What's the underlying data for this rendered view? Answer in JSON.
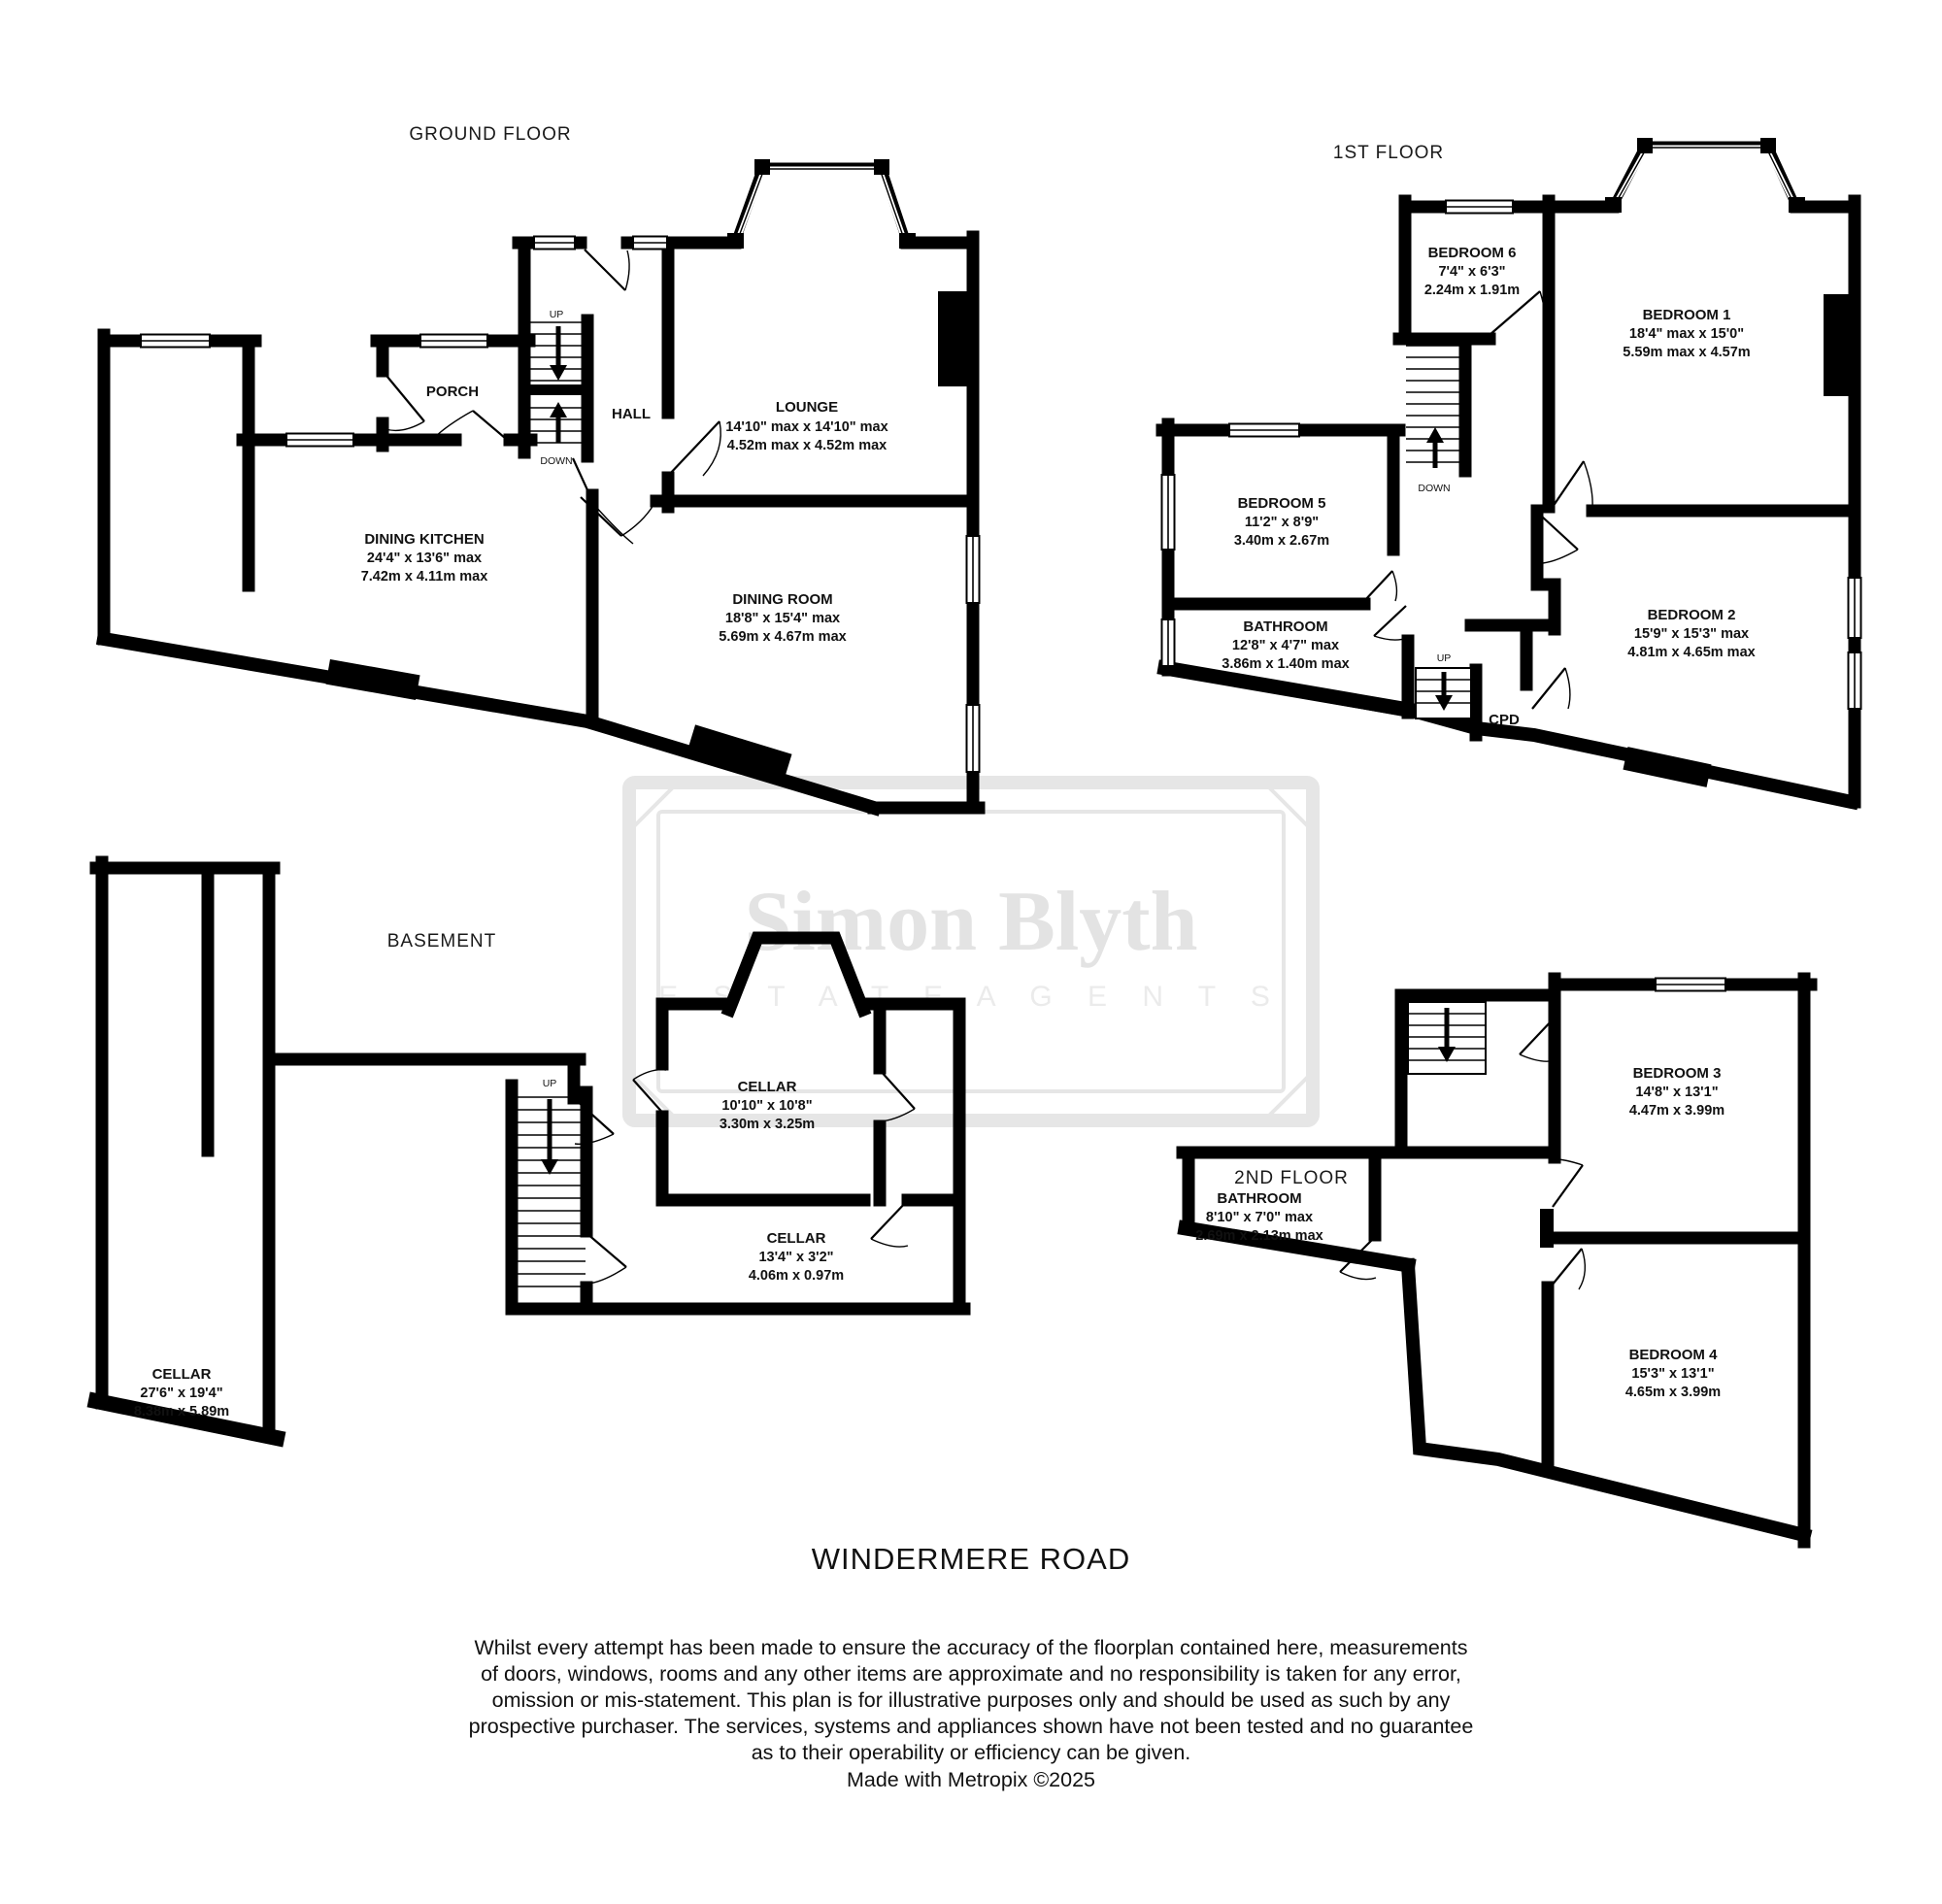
{
  "colors": {
    "wall": "#000000",
    "background": "#ffffff",
    "watermark": "#e3e3e3"
  },
  "labels": {
    "up": "UP",
    "down": "DOWN"
  },
  "watermark": {
    "line1": "Simon Blyth",
    "line2": "E S T A T E   A G E N T S"
  },
  "title": "WINDERMERE ROAD",
  "credit": "Made with Metropix ©2025",
  "disclaimer": [
    "Whilst every attempt has been made to ensure the accuracy of the floorplan contained here, measurements",
    "of doors, windows, rooms and any other items are approximate and no responsibility is taken for any error,",
    "omission or mis-statement. This plan is for illustrative purposes only and should be used as such by any",
    "prospective purchaser. The services, systems and appliances shown have not been tested and no guarantee",
    "as to their operability or efficiency can be given."
  ],
  "floors": [
    {
      "title": "GROUND FLOOR",
      "rooms": [
        {
          "name": "LOUNGE",
          "dims1": "14'10\" max x 14'10\" max",
          "dims2": "4.52m max x 4.52m max"
        },
        {
          "name": "DINING ROOM",
          "dims1": "18'8\"  x 15'4\" max",
          "dims2": "5.69m  x 4.67m max"
        },
        {
          "name": "DINING KITCHEN",
          "dims1": "24'4\"  x 13'6\" max",
          "dims2": "7.42m  x 4.11m max"
        },
        {
          "name": "HALL"
        },
        {
          "name": "PORCH"
        }
      ]
    },
    {
      "title": "1ST FLOOR",
      "rooms": [
        {
          "name": "BEDROOM 6",
          "dims1": "7'4\"  x 6'3\"",
          "dims2": "2.24m  x 1.91m"
        },
        {
          "name": "BEDROOM 1",
          "dims1": "18'4\" max x 15'0\"",
          "dims2": "5.59m max x 4.57m"
        },
        {
          "name": "BEDROOM 5",
          "dims1": "11'2\"  x 8'9\"",
          "dims2": "3.40m  x 2.67m"
        },
        {
          "name": "BATHROOM",
          "dims1": "12'8\"  x 4'7\" max",
          "dims2": "3.86m  x 1.40m max"
        },
        {
          "name": "BEDROOM 2",
          "dims1": "15'9\"  x 15'3\" max",
          "dims2": "4.81m  x 4.65m max"
        },
        {
          "name": "CPD"
        }
      ]
    },
    {
      "title": "BASEMENT",
      "rooms": [
        {
          "name": "CELLAR",
          "dims1": "27'6\"  x 19'4\"",
          "dims2": "8.38m  x 5.89m"
        },
        {
          "name": "CELLAR",
          "dims1": "10'10\"  x 10'8\"",
          "dims2": "3.30m  x 3.25m"
        },
        {
          "name": "CELLAR",
          "dims1": "13'4\"  x 3'2\"",
          "dims2": "4.06m  x 0.97m"
        }
      ]
    },
    {
      "title": "2ND FLOOR",
      "rooms": [
        {
          "name": "BEDROOM 3",
          "dims1": "14'8\"  x 13'1\"",
          "dims2": "4.47m  x 3.99m"
        },
        {
          "name": "BATHROOM",
          "dims1": "8'10\"  x 7'0\" max",
          "dims2": "2.69m  x 2.13m max"
        },
        {
          "name": "BEDROOM 4",
          "dims1": "15'3\"  x 13'1\"",
          "dims2": "4.65m  x 3.99m"
        }
      ]
    }
  ]
}
